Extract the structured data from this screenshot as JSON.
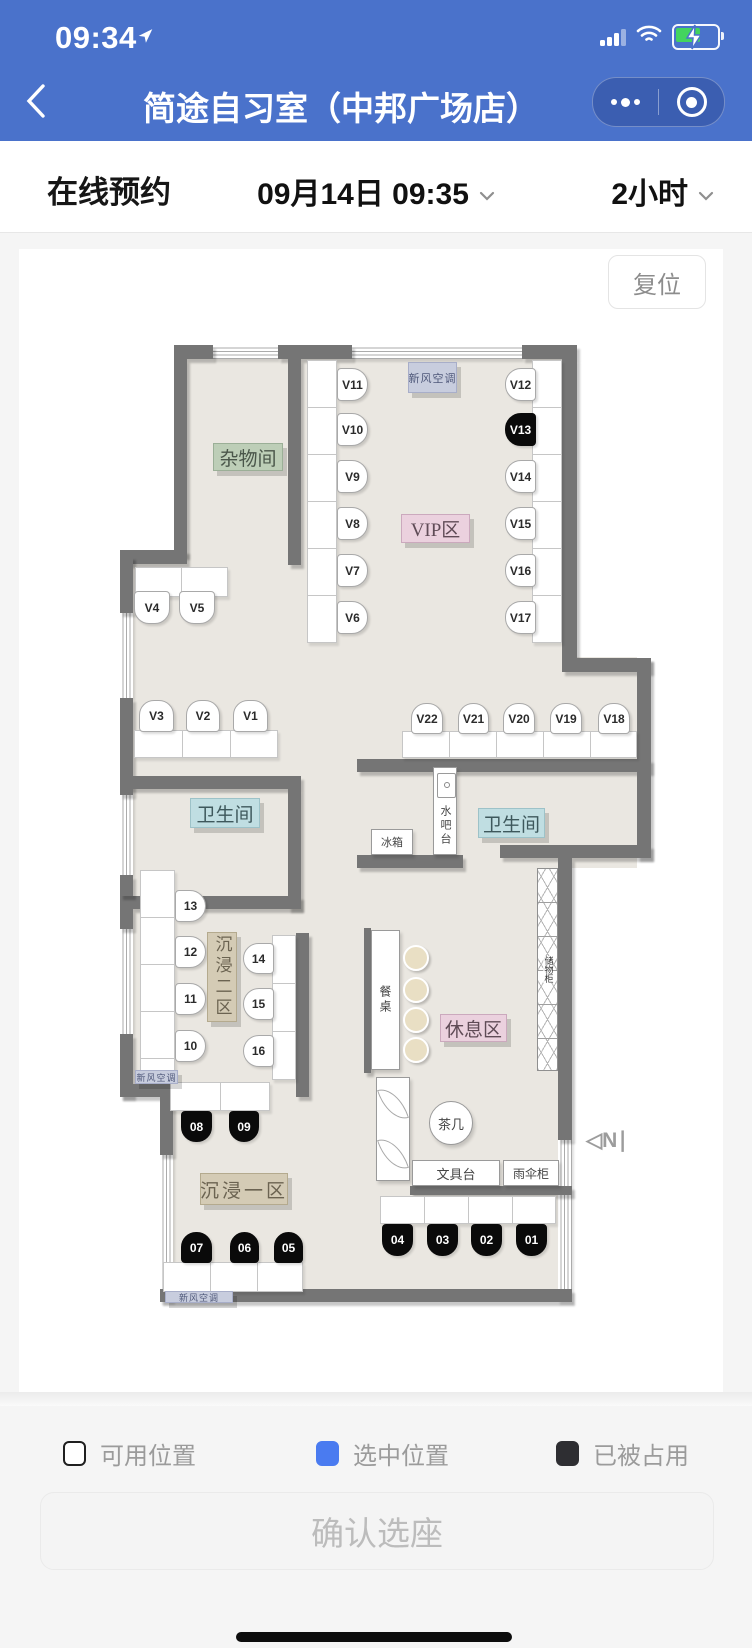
{
  "status_bar": {
    "time": "09:34"
  },
  "nav": {
    "title": "简途自习室（中邦广场店）"
  },
  "booking": {
    "tab": "在线预约",
    "datetime": "09月14日 09:35",
    "duration": "2小时"
  },
  "map": {
    "reset": "复位",
    "north": "◁N∣"
  },
  "plan": {
    "floor_color": "#eae7e1",
    "wall_color": "#757575",
    "floors": [
      [
        168,
        110,
        101,
        197
      ],
      [
        282,
        110,
        261,
        299
      ],
      [
        114,
        307,
        168,
        220
      ],
      [
        282,
        408,
        336,
        115
      ],
      [
        114,
        540,
        168,
        107
      ],
      [
        438,
        523,
        180,
        96
      ],
      [
        282,
        523,
        156,
        96
      ],
      [
        114,
        647,
        168,
        406
      ],
      [
        282,
        619,
        257,
        434
      ]
    ],
    "white_patches": [
      [
        101,
        848,
        40,
        205
      ]
    ],
    "walls": [
      [
        155,
        96,
        39,
        14
      ],
      [
        259,
        96,
        74,
        14
      ],
      [
        503,
        96,
        55,
        14
      ],
      [
        155,
        110,
        13,
        197
      ],
      [
        269,
        110,
        13,
        206
      ],
      [
        101,
        301,
        67,
        14
      ],
      [
        101,
        307,
        13,
        57
      ],
      [
        101,
        449,
        13,
        91
      ],
      [
        108,
        527,
        174,
        13
      ],
      [
        269,
        540,
        13,
        120
      ],
      [
        101,
        647,
        181,
        13
      ],
      [
        101,
        540,
        13,
        6
      ],
      [
        101,
        626,
        13,
        21
      ],
      [
        101,
        660,
        13,
        20
      ],
      [
        101,
        785,
        13,
        63
      ],
      [
        101,
        835,
        130,
        13
      ],
      [
        141,
        848,
        13,
        58
      ],
      [
        141,
        1040,
        412,
        13
      ],
      [
        543,
        110,
        15,
        299
      ],
      [
        543,
        409,
        89,
        14
      ],
      [
        618,
        409,
        14,
        114
      ],
      [
        338,
        510,
        294,
        13
      ],
      [
        618,
        523,
        14,
        86
      ],
      [
        338,
        606,
        106,
        13
      ],
      [
        481,
        596,
        151,
        13
      ],
      [
        539,
        609,
        14,
        282
      ],
      [
        277,
        684,
        13,
        164
      ],
      [
        345,
        679,
        7,
        145
      ],
      [
        391,
        937,
        162,
        9
      ]
    ],
    "windows": [
      {
        "r": [
          194,
          96,
          65,
          14
        ],
        "o": "h"
      },
      {
        "r": [
          333,
          96,
          170,
          14
        ],
        "o": "h"
      },
      {
        "r": [
          101,
          364,
          13,
          85
        ],
        "o": "v"
      },
      {
        "r": [
          101,
          546,
          13,
          80
        ],
        "o": "v"
      },
      {
        "r": [
          101,
          680,
          13,
          105
        ],
        "o": "v"
      },
      {
        "r": [
          141,
          906,
          13,
          147
        ],
        "o": "v"
      },
      {
        "r": [
          539,
          891,
          14,
          162
        ],
        "o": "v"
      }
    ],
    "desks": [
      {
        "r": [
          288,
          111,
          30,
          283
        ],
        "div": "h",
        "step": 47
      },
      {
        "r": [
          513,
          111,
          30,
          283
        ],
        "div": "h",
        "step": 47
      },
      {
        "r": [
          116,
          318,
          93,
          30
        ],
        "div": "v",
        "step": 46
      },
      {
        "r": [
          115,
          481,
          144,
          28
        ],
        "div": "v",
        "step": 48
      },
      {
        "r": [
          383,
          482,
          235,
          27
        ],
        "div": "v",
        "step": 47
      },
      {
        "r": [
          121,
          621,
          35,
          205
        ],
        "div": "h",
        "step": 47
      },
      {
        "r": [
          253,
          686,
          24,
          145
        ],
        "div": "h",
        "step": 48
      },
      {
        "r": [
          151,
          833,
          100,
          29
        ],
        "div": "v",
        "step": 50
      },
      {
        "r": [
          144,
          1013,
          140,
          30
        ],
        "div": "v",
        "step": 47
      },
      {
        "r": [
          361,
          947,
          176,
          28
        ],
        "div": "v",
        "step": 44
      }
    ],
    "seats": [
      {
        "id": "V11",
        "x": 318,
        "y": 119,
        "w": 31,
        "h": 33,
        "dir": "right",
        "occ": false
      },
      {
        "id": "V10",
        "x": 318,
        "y": 164,
        "w": 31,
        "h": 33,
        "dir": "right",
        "occ": false
      },
      {
        "id": "V9",
        "x": 318,
        "y": 211,
        "w": 31,
        "h": 33,
        "dir": "right",
        "occ": false
      },
      {
        "id": "V8",
        "x": 318,
        "y": 258,
        "w": 31,
        "h": 33,
        "dir": "right",
        "occ": false
      },
      {
        "id": "V7",
        "x": 318,
        "y": 305,
        "w": 31,
        "h": 33,
        "dir": "right",
        "occ": false
      },
      {
        "id": "V6",
        "x": 318,
        "y": 352,
        "w": 31,
        "h": 33,
        "dir": "right",
        "occ": false
      },
      {
        "id": "V12",
        "x": 486,
        "y": 119,
        "w": 31,
        "h": 33,
        "dir": "left",
        "occ": false
      },
      {
        "id": "V13",
        "x": 486,
        "y": 164,
        "w": 31,
        "h": 33,
        "dir": "left",
        "occ": true
      },
      {
        "id": "V14",
        "x": 486,
        "y": 211,
        "w": 31,
        "h": 33,
        "dir": "left",
        "occ": false
      },
      {
        "id": "V15",
        "x": 486,
        "y": 258,
        "w": 31,
        "h": 33,
        "dir": "left",
        "occ": false
      },
      {
        "id": "V16",
        "x": 486,
        "y": 305,
        "w": 31,
        "h": 33,
        "dir": "left",
        "occ": false
      },
      {
        "id": "V17",
        "x": 486,
        "y": 352,
        "w": 31,
        "h": 33,
        "dir": "left",
        "occ": false
      },
      {
        "id": "V4",
        "x": 115,
        "y": 342,
        "w": 36,
        "h": 33,
        "dir": "bottom",
        "occ": false
      },
      {
        "id": "V5",
        "x": 160,
        "y": 342,
        "w": 36,
        "h": 33,
        "dir": "bottom",
        "occ": false
      },
      {
        "id": "V3",
        "x": 120,
        "y": 451,
        "w": 35,
        "h": 32,
        "dir": "top",
        "occ": false
      },
      {
        "id": "V2",
        "x": 167,
        "y": 451,
        "w": 34,
        "h": 32,
        "dir": "top",
        "occ": false
      },
      {
        "id": "V1",
        "x": 214,
        "y": 451,
        "w": 35,
        "h": 32,
        "dir": "top",
        "occ": false
      },
      {
        "id": "V22",
        "x": 392,
        "y": 454,
        "w": 32,
        "h": 31,
        "dir": "top",
        "occ": false
      },
      {
        "id": "V21",
        "x": 439,
        "y": 454,
        "w": 31,
        "h": 31,
        "dir": "top",
        "occ": false
      },
      {
        "id": "V20",
        "x": 484,
        "y": 454,
        "w": 32,
        "h": 31,
        "dir": "top",
        "occ": false
      },
      {
        "id": "V19",
        "x": 531,
        "y": 454,
        "w": 32,
        "h": 31,
        "dir": "top",
        "occ": false
      },
      {
        "id": "V18",
        "x": 579,
        "y": 454,
        "w": 32,
        "h": 31,
        "dir": "top",
        "occ": false
      },
      {
        "id": "13",
        "x": 156,
        "y": 641,
        "w": 31,
        "h": 32,
        "dir": "right",
        "occ": false
      },
      {
        "id": "12",
        "x": 156,
        "y": 687,
        "w": 31,
        "h": 32,
        "dir": "right",
        "occ": false
      },
      {
        "id": "11",
        "x": 156,
        "y": 734,
        "w": 31,
        "h": 32,
        "dir": "right",
        "occ": false
      },
      {
        "id": "10",
        "x": 156,
        "y": 781,
        "w": 31,
        "h": 32,
        "dir": "right",
        "occ": false
      },
      {
        "id": "14",
        "x": 224,
        "y": 694,
        "w": 31,
        "h": 31,
        "dir": "left",
        "occ": false
      },
      {
        "id": "15",
        "x": 224,
        "y": 739,
        "w": 31,
        "h": 32,
        "dir": "left",
        "occ": false
      },
      {
        "id": "16",
        "x": 224,
        "y": 786,
        "w": 31,
        "h": 32,
        "dir": "left",
        "occ": false
      },
      {
        "id": "08",
        "x": 162,
        "y": 862,
        "w": 31,
        "h": 31,
        "dir": "bottom",
        "occ": true
      },
      {
        "id": "09",
        "x": 210,
        "y": 862,
        "w": 30,
        "h": 31,
        "dir": "bottom",
        "occ": true
      },
      {
        "id": "07",
        "x": 162,
        "y": 983,
        "w": 31,
        "h": 31,
        "dir": "top",
        "occ": true
      },
      {
        "id": "06",
        "x": 211,
        "y": 983,
        "w": 29,
        "h": 31,
        "dir": "top",
        "occ": true
      },
      {
        "id": "05",
        "x": 255,
        "y": 983,
        "w": 29,
        "h": 31,
        "dir": "top",
        "occ": true
      },
      {
        "id": "04",
        "x": 363,
        "y": 975,
        "w": 31,
        "h": 32,
        "dir": "bottom",
        "occ": true
      },
      {
        "id": "03",
        "x": 408,
        "y": 975,
        "w": 31,
        "h": 32,
        "dir": "bottom",
        "occ": true
      },
      {
        "id": "02",
        "x": 452,
        "y": 975,
        "w": 31,
        "h": 32,
        "dir": "bottom",
        "occ": true
      },
      {
        "id": "01",
        "x": 497,
        "y": 975,
        "w": 31,
        "h": 32,
        "dir": "bottom",
        "occ": true
      }
    ],
    "labels": [
      {
        "t": "杂物间",
        "x": 194,
        "y": 194,
        "w": 70,
        "h": 28,
        "cls": "green",
        "fs": 19
      },
      {
        "t": "VIP区",
        "x": 382,
        "y": 265,
        "w": 69,
        "h": 29,
        "cls": "pink",
        "fs": 19
      },
      {
        "t": "新风空调",
        "x": 389,
        "y": 113,
        "w": 49,
        "h": 31,
        "cls": "lav",
        "fs": 11
      },
      {
        "t": "卫生间",
        "x": 171,
        "y": 549,
        "w": 70,
        "h": 30,
        "cls": "cyan",
        "fs": 19
      },
      {
        "t": "卫生间",
        "x": 459,
        "y": 559,
        "w": 67,
        "h": 30,
        "cls": "cyan",
        "fs": 19
      },
      {
        "t": "沉浸二区",
        "x": 188,
        "y": 683,
        "w": 30,
        "h": 90,
        "cls": "tan vert",
        "fs": 17
      },
      {
        "t": "沉浸一区",
        "x": 181,
        "y": 924,
        "w": 88,
        "h": 32,
        "cls": "tan",
        "fs": 19
      },
      {
        "t": "休息区",
        "x": 421,
        "y": 765,
        "w": 67,
        "h": 28,
        "cls": "pink",
        "fs": 19
      },
      {
        "t": "新风空调",
        "x": 116,
        "y": 821,
        "w": 43,
        "h": 14,
        "cls": "lav",
        "fs": 9
      },
      {
        "t": "新风空调",
        "x": 146,
        "y": 1042,
        "w": 68,
        "h": 12,
        "cls": "lav",
        "fs": 9
      }
    ],
    "furniture": [
      {
        "kind": "waterbar",
        "t": "水吧台",
        "x": 414,
        "y": 518,
        "w": 24,
        "h": 88,
        "fs": 11
      },
      {
        "kind": "box",
        "t": "冰箱",
        "x": 352,
        "y": 580,
        "w": 42,
        "h": 26,
        "fs": 11
      },
      {
        "kind": "vtable",
        "t": "餐桌",
        "x": 352,
        "y": 681,
        "w": 29,
        "h": 140,
        "fs": 12
      },
      {
        "kind": "circle",
        "t": "茶几",
        "x": 410,
        "y": 852,
        "w": 44,
        "h": 44,
        "fs": 13
      },
      {
        "kind": "sofa",
        "t": "",
        "x": 357,
        "y": 828,
        "w": 34,
        "h": 104,
        "fs": 0
      },
      {
        "kind": "box",
        "t": "文具台",
        "x": 393,
        "y": 911,
        "w": 88,
        "h": 26,
        "fs": 13
      },
      {
        "kind": "box",
        "t": "雨伞柜",
        "x": 484,
        "y": 911,
        "w": 56,
        "h": 26,
        "fs": 12
      },
      {
        "kind": "locker",
        "t": "储物柜",
        "x": 518,
        "y": 619,
        "w": 21,
        "h": 203,
        "fs": 9
      }
    ],
    "stools": [
      [
        384,
        696
      ],
      [
        384,
        728
      ],
      [
        384,
        758
      ],
      [
        384,
        788
      ]
    ],
    "north_pos": [
      567,
      879
    ]
  },
  "legend": {
    "items": [
      {
        "label": "可用位置",
        "color": "#ffffff",
        "border": "#1f1f1f",
        "x": 63
      },
      {
        "label": "选中位置",
        "color": "#4a7bf0",
        "border": "#4a7bf0",
        "x": 316
      },
      {
        "label": "已被占用",
        "color": "#2e2e32",
        "border": "#2e2e32",
        "x": 556
      }
    ]
  },
  "footer": {
    "confirm": "确认选座"
  }
}
